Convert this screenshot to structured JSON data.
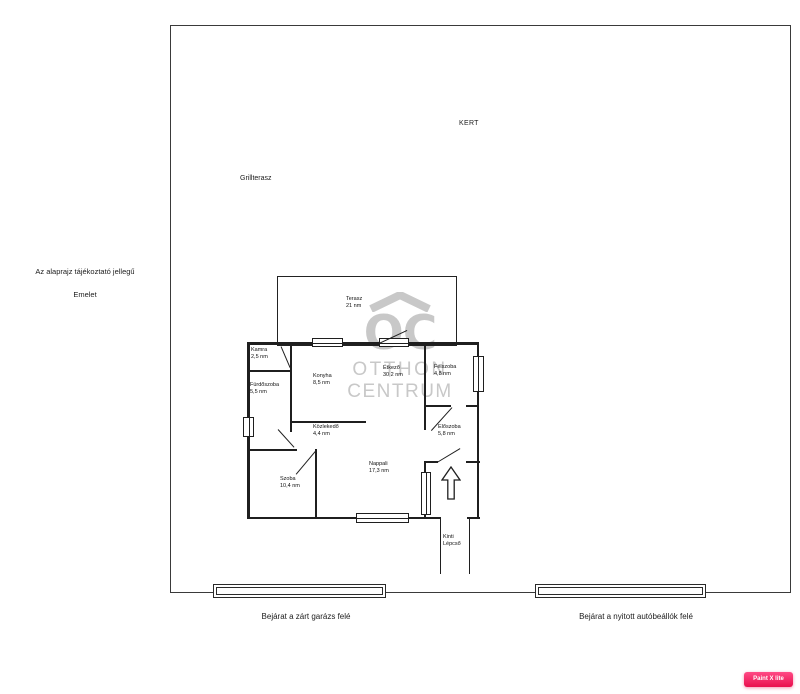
{
  "site": {
    "kert": "KERT",
    "grillterasz": "Grillterasz",
    "disclaimer": "Az alaprajz tájékoztató jellegű",
    "floor_label": "Emelet",
    "entrance_left": "Bejárat a zárt garázs felé",
    "entrance_right": "Bejárat a nyitott autóbeállók felé"
  },
  "watermark": {
    "monogram": "OC",
    "line2": "OTTHON",
    "line3": "CENTRUM",
    "color": "#c8c8c8"
  },
  "rooms": [
    {
      "name": "Terasz",
      "area": "21 nm"
    },
    {
      "name": "Kamra",
      "area": "2,5 nm"
    },
    {
      "name": "Fürdőszoba",
      "area": "5,5 nm"
    },
    {
      "name": "Konyha",
      "area": "8,5 nm"
    },
    {
      "name": "Étkező",
      "area": "30,2 nm"
    },
    {
      "name": "Félszoba",
      "area": "4,8 nm"
    },
    {
      "name": "Közlekedő",
      "area": "4,4 nm"
    },
    {
      "name": "Előszoba",
      "area": "5,8 nm"
    },
    {
      "name": "Szoba",
      "area": "10,4 nm"
    },
    {
      "name": "Nappali",
      "area": "17,3 nm"
    }
  ],
  "stairs": {
    "line1": "Kinti",
    "line2": "Lépcső"
  },
  "badge": {
    "label": "Paint X lite",
    "color_from": "#ff4a85",
    "color_to": "#e90f4d"
  }
}
